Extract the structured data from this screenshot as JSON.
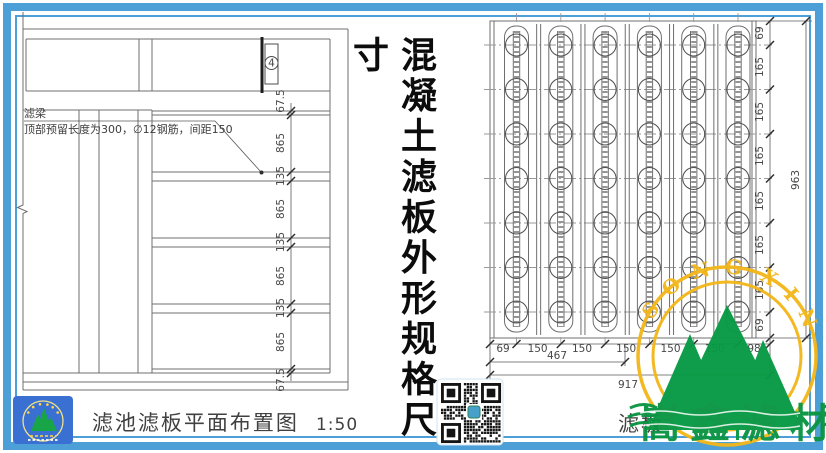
{
  "frame": {
    "color": "#4c9fd7"
  },
  "title": {
    "vertical_text": "混凝土滤板外形规格尺寸"
  },
  "left_drawing": {
    "caption": "滤池滤板平面布置图",
    "scale": "1:50",
    "beam_label": "滤梁",
    "beam_note": "顶部预留长度为300，∅12钢筋，间距150",
    "detail_marker": "4",
    "dims": [
      "67.5",
      "865",
      "135",
      "865",
      "135",
      "865",
      "135",
      "865",
      "67.5"
    ]
  },
  "right_drawing": {
    "caption_fragment": "滤板",
    "side_dims": [
      "69",
      "165",
      "165",
      "165",
      "165",
      "165",
      "165",
      "69"
    ],
    "side_total": "963",
    "bottom_dims": [
      "69",
      "150",
      "150",
      "150",
      "150",
      "150",
      "98"
    ],
    "bottom_sub_total": "467",
    "bottom_total": "917"
  },
  "watermark": {
    "arc_left": "SONG",
    "arc_right": "XIN",
    "cn_text": "嵩鑫滤材",
    "ring_color": "#f3b71b",
    "mountain_color": "#079a44",
    "text_color": "#0a9442"
  }
}
